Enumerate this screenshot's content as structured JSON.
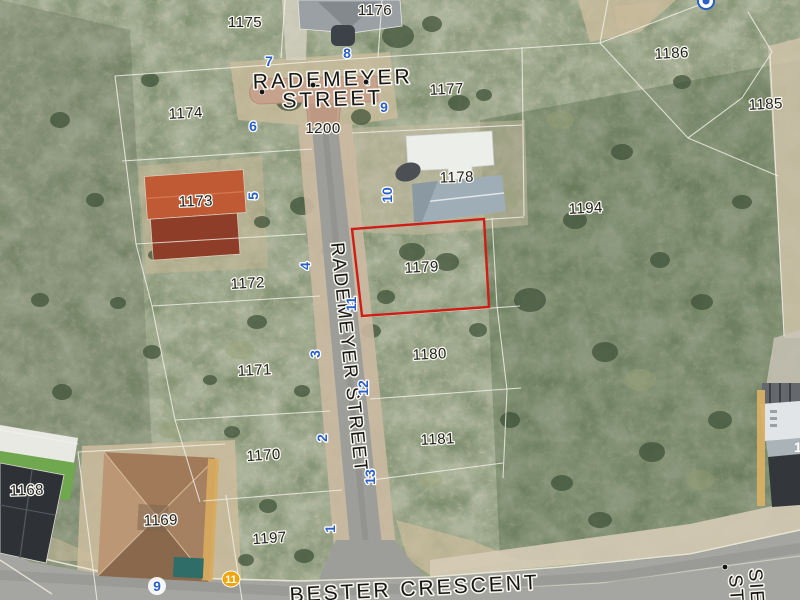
{
  "map": {
    "streets": {
      "rademeyer_line1": "RADEMEYER",
      "rademeyer_line2": "STREET",
      "rademeyer_vertical": "RADEMEYER STREET",
      "bester": "BESTER CRESCENT",
      "side_street_line1": "SIE",
      "side_street_line2": "ST",
      "road_number": "1200"
    },
    "highlighted_parcel": "1179",
    "partial_label_right_edge": "1",
    "parcel_labels": [
      {
        "text": "1175",
        "x": 245,
        "y": 27,
        "rot": 0
      },
      {
        "text": "1176",
        "x": 375,
        "y": 15,
        "rot": 0
      },
      {
        "text": "1186",
        "x": 672,
        "y": 58,
        "rot": -3
      },
      {
        "text": "1185",
        "x": 766,
        "y": 109,
        "rot": -3
      },
      {
        "text": "1174",
        "x": 186,
        "y": 118,
        "rot": -3
      },
      {
        "text": "1177",
        "x": 447,
        "y": 94,
        "rot": -3
      },
      {
        "text": "1173",
        "x": 196,
        "y": 206,
        "rot": -2
      },
      {
        "text": "1178",
        "x": 457,
        "y": 182,
        "rot": -2
      },
      {
        "text": "1194",
        "x": 586,
        "y": 213,
        "rot": -3
      },
      {
        "text": "1179",
        "x": 422,
        "y": 272,
        "rot": -3
      },
      {
        "text": "1172",
        "x": 248,
        "y": 288,
        "rot": -3
      },
      {
        "text": "1171",
        "x": 255,
        "y": 375,
        "rot": -3
      },
      {
        "text": "1180",
        "x": 430,
        "y": 359,
        "rot": -3
      },
      {
        "text": "1181",
        "x": 438,
        "y": 444,
        "rot": -3
      },
      {
        "text": "1170",
        "x": 264,
        "y": 460,
        "rot": -4
      },
      {
        "text": "1168",
        "x": 27,
        "y": 495,
        "rot": -2
      },
      {
        "text": "1169",
        "x": 161,
        "y": 525,
        "rot": -2
      },
      {
        "text": "1197",
        "x": 270,
        "y": 543,
        "rot": -4
      }
    ],
    "address_markers_blue": [
      {
        "text": "7",
        "x": 269,
        "y": 66,
        "rot": 0
      },
      {
        "text": "8",
        "x": 347,
        "y": 58,
        "rot": 0
      },
      {
        "text": "9",
        "x": 384,
        "y": 112,
        "rot": 0
      },
      {
        "text": "6",
        "x": 253,
        "y": 131,
        "rot": 0
      },
      {
        "text": "5",
        "x": 258,
        "y": 196,
        "rot": -90
      },
      {
        "text": "10",
        "x": 392,
        "y": 195,
        "rot": -90
      },
      {
        "text": "4",
        "x": 310,
        "y": 266,
        "rot": -90
      },
      {
        "text": "11",
        "x": 356,
        "y": 304,
        "rot": -90
      },
      {
        "text": "3",
        "x": 320,
        "y": 354,
        "rot": -90
      },
      {
        "text": "12",
        "x": 368,
        "y": 388,
        "rot": -90
      },
      {
        "text": "2",
        "x": 327,
        "y": 438,
        "rot": -90
      },
      {
        "text": "13",
        "x": 375,
        "y": 477,
        "rot": -90
      },
      {
        "text": "1",
        "x": 335,
        "y": 529,
        "rot": -90
      },
      {
        "text": "9",
        "x": 157,
        "y": 591,
        "rot": 0,
        "halo_circle": true
      }
    ],
    "address_marker_yellow": {
      "text": "11",
      "x": 231,
      "y": 579
    },
    "survey_dots": [
      {
        "x": 262,
        "y": 92
      },
      {
        "x": 313,
        "y": 85
      },
      {
        "x": 366,
        "y": 82
      },
      {
        "x": 725,
        "y": 567
      }
    ],
    "colors": {
      "parcel_line": "#f2f1e8",
      "highlight_red": "#cf1d15",
      "marker_blue": "#2a5fc7",
      "marker_yellow": "#f0a50a",
      "label_dark": "#1f1f1f",
      "road_paved": "#9d9d99",
      "road_brick": "#c6a28d",
      "road_bester": "#a5a5a1",
      "sand": "#cdbd9d"
    }
  }
}
